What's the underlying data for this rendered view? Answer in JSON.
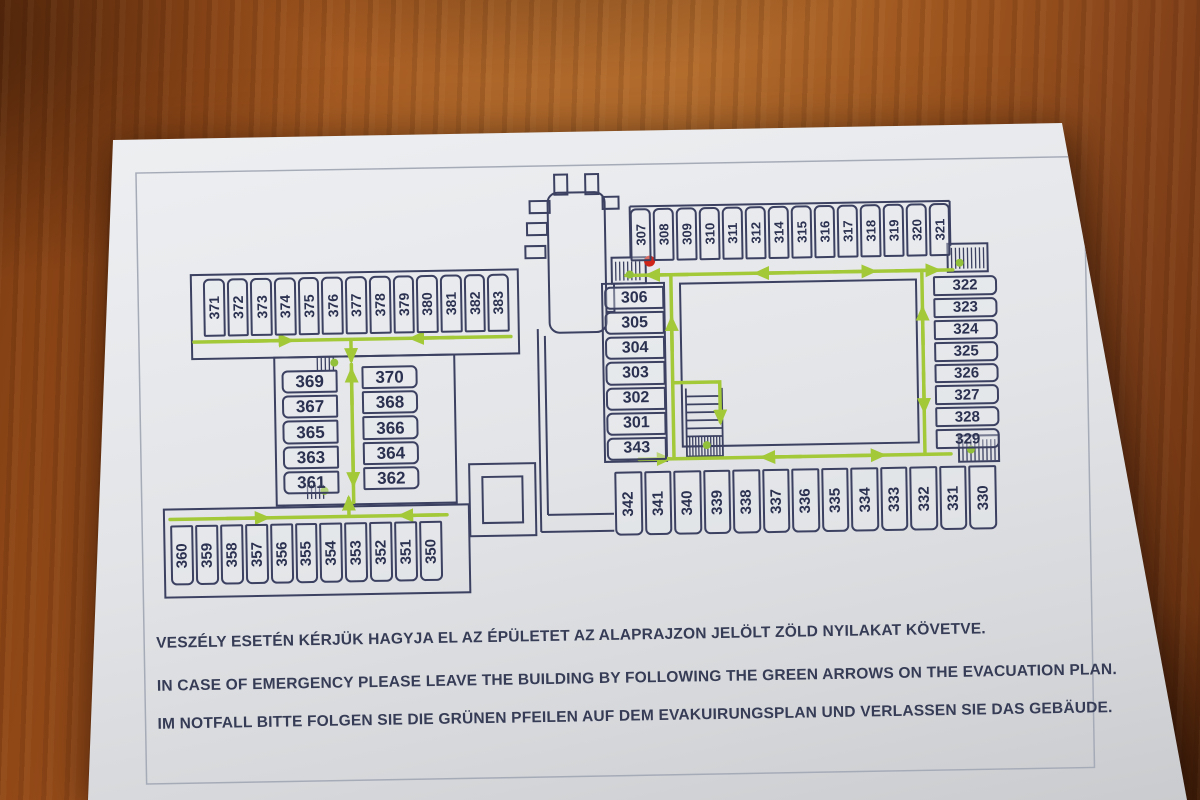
{
  "plan": {
    "rooms": {
      "top_left_row": [
        "371",
        "372",
        "373",
        "374",
        "375",
        "376",
        "377",
        "378",
        "379",
        "380",
        "381",
        "382",
        "383"
      ],
      "mid_left_col_a": [
        "369",
        "367",
        "365",
        "363",
        "361"
      ],
      "mid_left_col_b": [
        "370",
        "368",
        "366",
        "364",
        "362"
      ],
      "bottom_left_row": [
        "360",
        "359",
        "358",
        "357",
        "356",
        "355",
        "354",
        "353",
        "352",
        "351",
        "350"
      ],
      "center_col": [
        "306",
        "305",
        "304",
        "303",
        "302",
        "301",
        "343"
      ],
      "top_right_row": [
        "307",
        "308",
        "309",
        "310",
        "311",
        "312",
        "314",
        "315",
        "316",
        "317",
        "318",
        "319",
        "320",
        "321"
      ],
      "right_col": [
        "322",
        "323",
        "324",
        "325",
        "326",
        "327",
        "328",
        "329"
      ],
      "bottom_right_row": [
        "342",
        "341",
        "340",
        "339",
        "338",
        "337",
        "336",
        "335",
        "334",
        "333",
        "332",
        "331",
        "330"
      ]
    },
    "notices": {
      "hu": "VESZÉLY ESETÉN KÉRJÜK HAGYJA EL AZ ÉPÜLETET AZ ALAPRAJZON JELÖLT ZÖLD NYILAKAT KÖVETVE.",
      "en": "IN CASE OF EMERGENCY PLEASE LEAVE THE BUILDING BY FOLLOWING THE GREEN ARROWS ON THE EVACUATION PLAN.",
      "de": "IM NOTFALL BITTE FOLGEN SIE DIE GRÜNEN PFEILEN AUF DEM EVAKUIRUNGSPLAN UND VERLASSEN SIE DAS GEBÄUDE."
    },
    "colors": {
      "wall": "#3c4162",
      "room_number": "#2b3150",
      "route_green": "#a3c838",
      "exit_dot_green": "#93c03a",
      "location_dot_red": "#cf2518"
    }
  }
}
